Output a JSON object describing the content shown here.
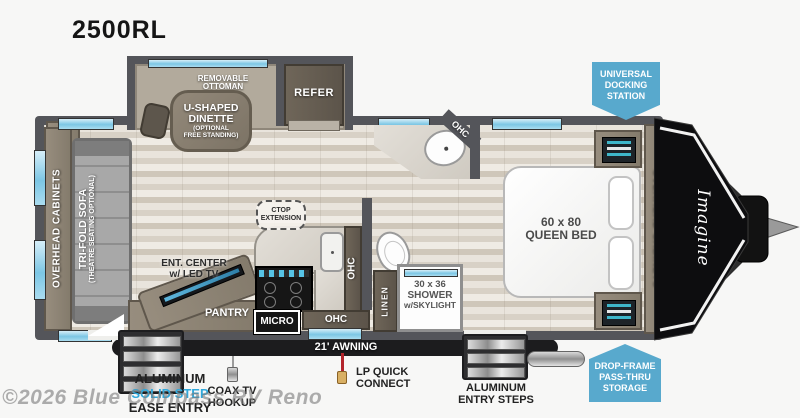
{
  "title": "2500RL",
  "watermark": "©2026 Blue Compass RV Reno",
  "colors": {
    "badge_blue": "#58A9CD",
    "solid_step_blue": "#2FA8DC",
    "wall_gray": "#54555A",
    "window_blue": "#7CC6E4",
    "awning_black": "#1C1C1E"
  },
  "badges": {
    "universal_docking": {
      "lines": [
        "UNIVERSAL",
        "DOCKING",
        "STATION"
      ]
    },
    "drop_frame": {
      "lines": [
        "DROP-FRAME",
        "PASS-THRU",
        "STORAGE"
      ]
    }
  },
  "rooms": {
    "dinette": {
      "ottoman": "REMOVABLE OTTOMAN",
      "label_line1": "U-SHAPED",
      "label_line2": "DINETTE",
      "sub_line1": "(OPTIONAL",
      "sub_line2": "FREE STANDING)"
    },
    "refrigerator": "REFER",
    "rear_overhead_cabinets": "OVERHEAD CABINETS",
    "sofa": {
      "label": "TRI-FOLD SOFA",
      "sub": "(THEATRE SEATING OPTIONAL)"
    },
    "entertainment": {
      "line1": "ENT. CENTER",
      "line2": "w/ LED TV"
    },
    "pantry": "PANTRY",
    "microwave": "MICRO",
    "ohc": "OHC",
    "ctop": {
      "line1": "CTOP",
      "line2": "EXTENSION"
    },
    "linen": "LINEN",
    "shower": {
      "line1": "30 x 36",
      "line2": "SHOWER",
      "line3": "w/SKYLIGHT"
    },
    "bed": {
      "line1": "60 x 80",
      "line2": "QUEEN BED"
    },
    "front_overhead_cabinets": "OVERHEAD CABINETS",
    "brand_logo": "Imagine"
  },
  "exterior": {
    "awning": "21' AWNING",
    "solid_step": {
      "line1": "ALUMINUM",
      "line2": "SOLID STEP",
      "line3": "EASE ENTRY"
    },
    "coax": {
      "line1": "COAX TV",
      "line2": "HOOKUP"
    },
    "lp": {
      "line1": "LP QUICK",
      "line2": "CONNECT"
    },
    "entry_steps": {
      "line1": "ALUMINUM",
      "line2": "ENTRY STEPS"
    }
  }
}
